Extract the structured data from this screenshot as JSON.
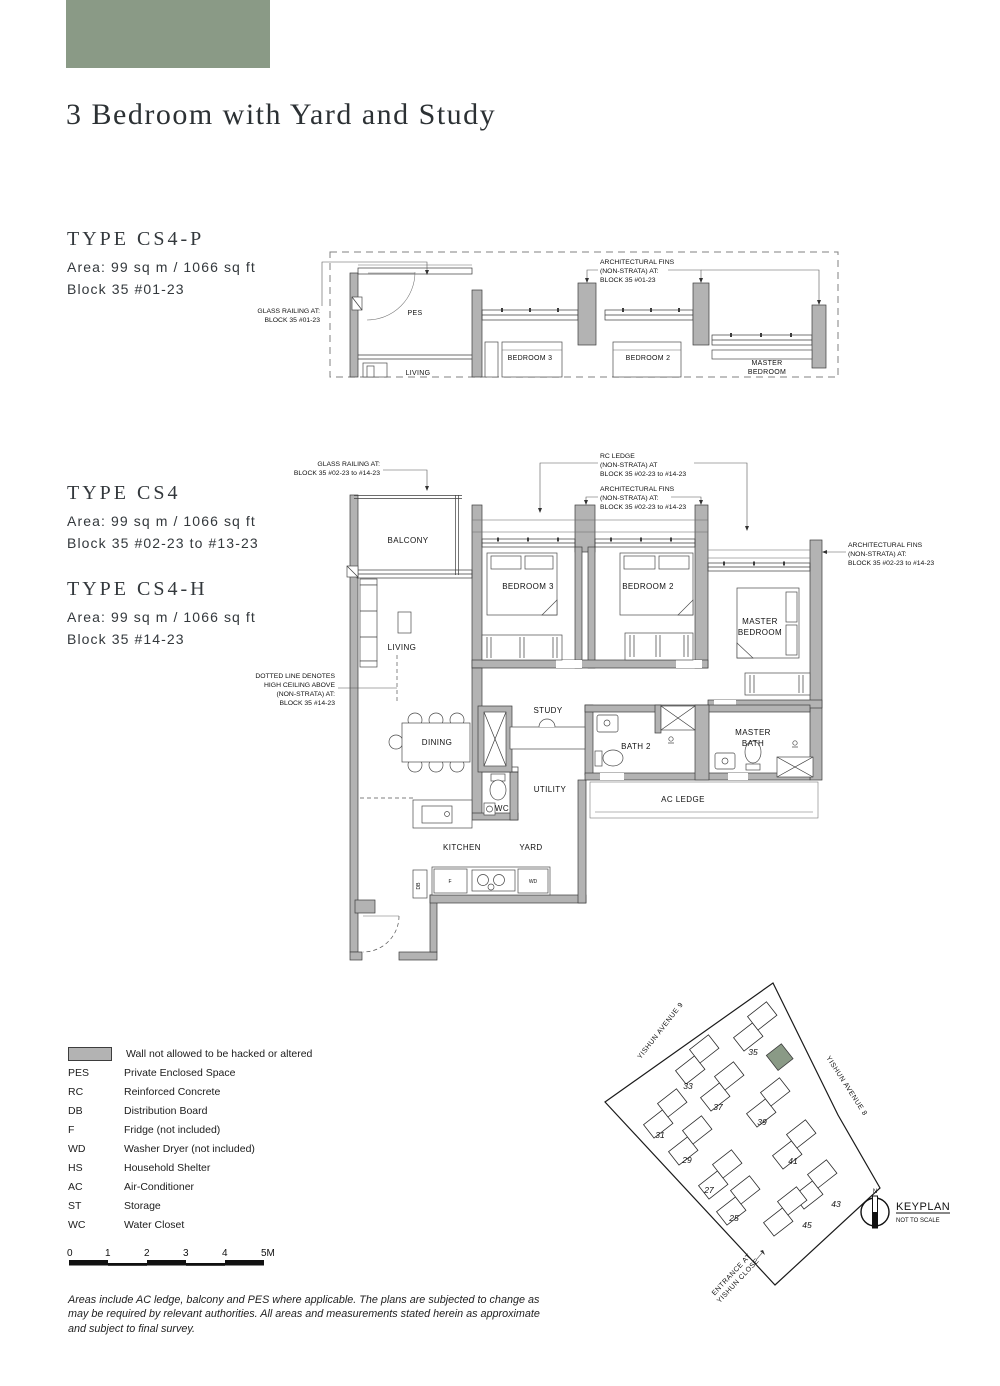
{
  "page": {
    "title": "3 Bedroom with Yard and Study",
    "accent_color": "#8a9a86",
    "wall_color": "#b3b3b3"
  },
  "types": [
    {
      "name": "TYPE CS4-P",
      "area": "Area: 99 sq m / 1066 sq ft",
      "block": "Block 35 #01-23"
    },
    {
      "name": "TYPE CS4",
      "area": "Area: 99 sq m / 1066 sq ft",
      "block": "Block 35 #02-23 to #13-23"
    },
    {
      "name": "TYPE CS4-H",
      "area": "Area: 99 sq m / 1066 sq ft",
      "block": "Block 35 #14-23"
    }
  ],
  "top_plan": {
    "rooms": {
      "pes": "PES",
      "living": "LIVING",
      "bedroom3": "BEDROOM 3",
      "bedroom2": "BEDROOM 2",
      "master": [
        "MASTER",
        "BEDROOM"
      ]
    },
    "annotations": {
      "glass_railing": [
        "GLASS RAILING AT:",
        "BLOCK 35 #01-23"
      ],
      "arch_fins": [
        "ARCHITECTURAL FINS",
        "(NON-STRATA) AT:",
        "BLOCK 35 #01-23"
      ]
    }
  },
  "main_plan": {
    "rooms": {
      "balcony": "BALCONY",
      "living": "LIVING",
      "bedroom3": "BEDROOM 3",
      "bedroom2": "BEDROOM 2",
      "master": [
        "MASTER",
        "BEDROOM"
      ],
      "study": "STUDY",
      "dining": "DINING",
      "bath2": "BATH 2",
      "master_bath": [
        "MASTER",
        "BATH"
      ],
      "utility": "UTILITY",
      "wc": "WC",
      "ac_ledge": "AC LEDGE",
      "kitchen": "KITCHEN",
      "yard": "YARD"
    },
    "fixtures": {
      "fridge": "F",
      "washer_dryer": "WD",
      "db": "DB"
    },
    "annotations": {
      "glass_railing": [
        "GLASS RAILING AT:",
        "BLOCK 35 #02-23 to #14-23"
      ],
      "rc_ledge": [
        "RC LEDGE",
        "(NON-STRATA) AT",
        "BLOCK 35 #02-23 to #14-23"
      ],
      "arch_fins_top": [
        "ARCHITECTURAL FINS",
        "(NON-STRATA) AT:",
        "BLOCK 35 #02-23 to #14-23"
      ],
      "arch_fins_right": [
        "ARCHITECTURAL FINS",
        "(NON-STRATA) AT:",
        "BLOCK 35 #02-23 to #14-23"
      ],
      "high_ceiling": [
        "DOTTED LINE DENOTES",
        "HIGH CEILING ABOVE",
        "(NON-STRATA) AT:",
        "BLOCK 35 #14-23"
      ]
    }
  },
  "legend": {
    "wall_note": "Wall not allowed to be hacked or altered",
    "items": [
      {
        "abbr": "PES",
        "desc": "Private Enclosed Space"
      },
      {
        "abbr": "RC",
        "desc": "Reinforced Concrete"
      },
      {
        "abbr": "DB",
        "desc": "Distribution Board"
      },
      {
        "abbr": "F",
        "desc": "Fridge (not included)"
      },
      {
        "abbr": "WD",
        "desc": "Washer Dryer (not included)"
      },
      {
        "abbr": "HS",
        "desc": "Household Shelter"
      },
      {
        "abbr": "AC",
        "desc": "Air-Conditioner"
      },
      {
        "abbr": "ST",
        "desc": "Storage"
      },
      {
        "abbr": "WC",
        "desc": "Water Closet"
      }
    ]
  },
  "scale_bar": {
    "ticks": [
      "0",
      "1",
      "2",
      "3",
      "4",
      "5M"
    ]
  },
  "disclaimer": "Areas include AC ledge, balcony and PES where applicable. The plans are subjected to change as may be required by relevant authorities. All areas and measurements stated herein as approximate and subject to final survey.",
  "keyplan": {
    "title": "KEYPLAN",
    "subtitle": "NOT TO SCALE",
    "north": "N",
    "roads": [
      "YISHUN AVENUE 9",
      "YISHUN AVENUE 8"
    ],
    "entrance": [
      "ENTRANCE AT",
      "YISHUN CLOSE"
    ],
    "highlight_color": "#8a9a86",
    "blocks": [
      {
        "label": "35",
        "x": 168,
        "y": 58,
        "lx": 163,
        "ly": 83
      },
      {
        "label": "33",
        "x": 110,
        "y": 91,
        "lx": 98,
        "ly": 117
      },
      {
        "label": "37",
        "x": 135,
        "y": 118,
        "lx": 128,
        "ly": 138
      },
      {
        "label": "39",
        "x": 181,
        "y": 134,
        "lx": 172,
        "ly": 153
      },
      {
        "label": "31",
        "x": 78,
        "y": 145,
        "lx": 70,
        "ly": 166
      },
      {
        "label": "29",
        "x": 103,
        "y": 172,
        "lx": 97,
        "ly": 191
      },
      {
        "label": "27",
        "x": 133,
        "y": 206,
        "lx": 119,
        "ly": 221
      },
      {
        "label": "25",
        "x": 151,
        "y": 232,
        "lx": 144,
        "ly": 249
      },
      {
        "label": "41",
        "x": 207,
        "y": 176,
        "lx": 203,
        "ly": 192
      },
      {
        "label": "43",
        "x": 228,
        "y": 216,
        "lx": 246,
        "ly": 235
      },
      {
        "label": "45",
        "x": 198,
        "y": 243,
        "lx": 217,
        "ly": 256
      }
    ]
  }
}
